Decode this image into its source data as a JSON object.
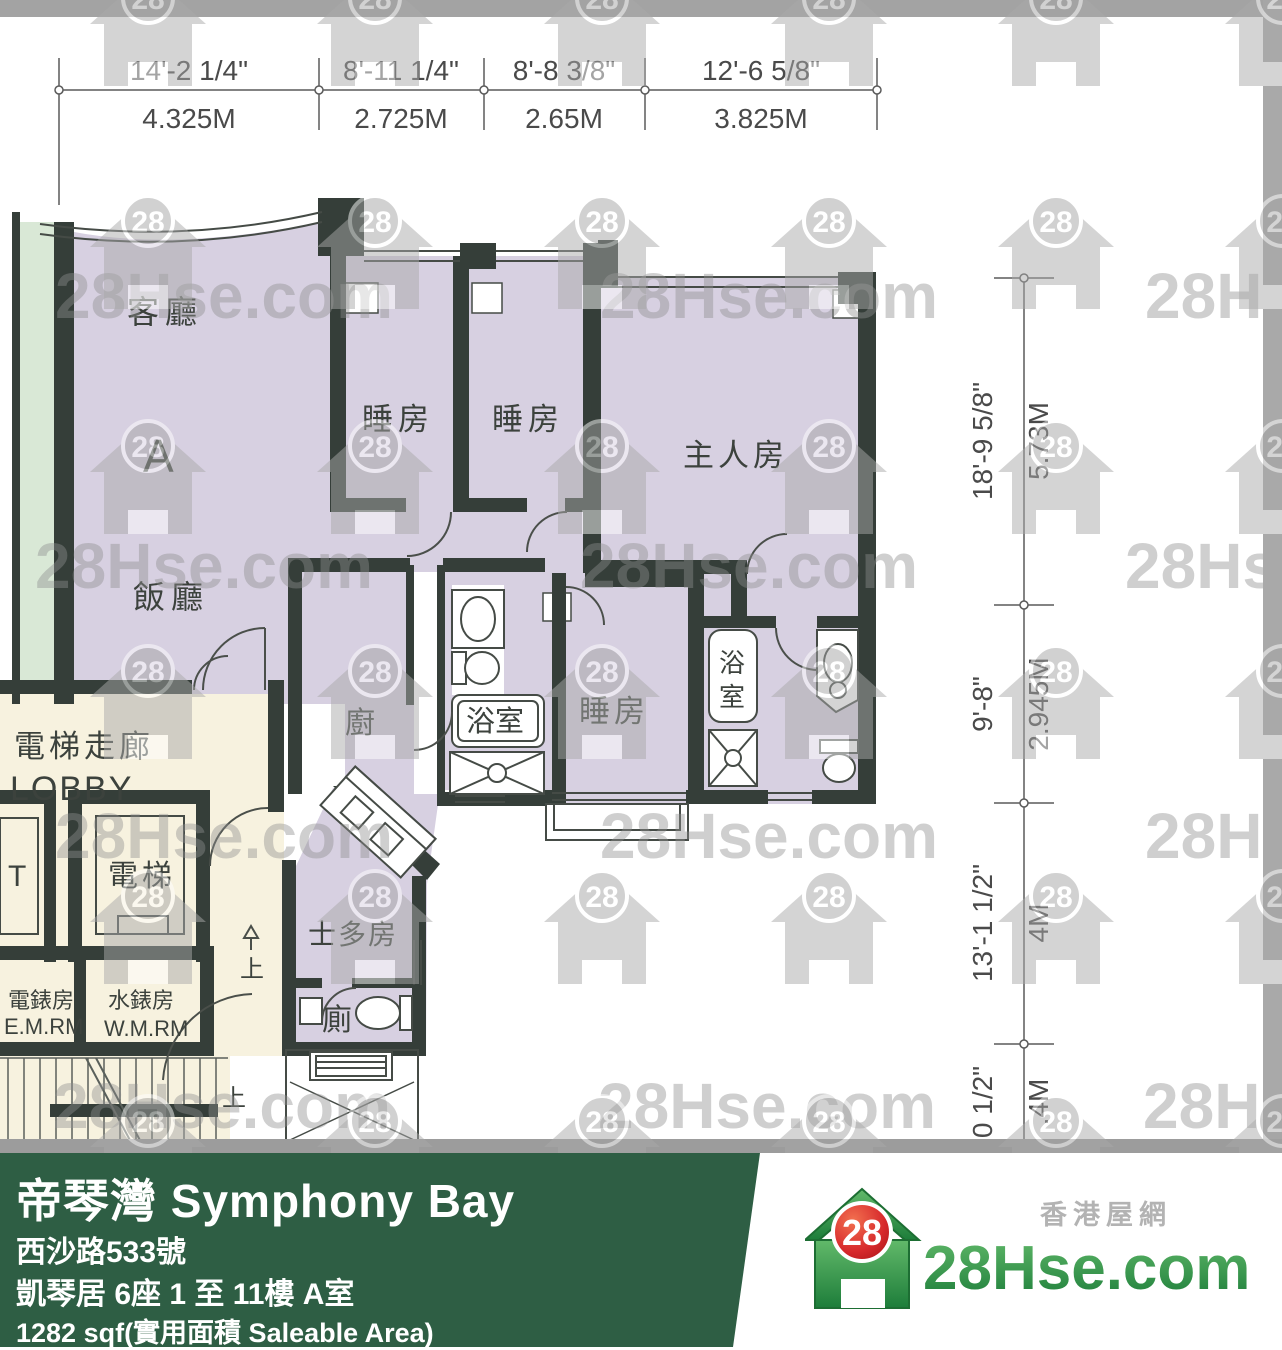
{
  "watermark": {
    "text": "28Hse.com",
    "badge": "28"
  },
  "dims_top": {
    "feet": [
      "14'-2 1/4\"",
      "8'-11 1/4\"",
      "8'-8 3/8\"",
      "12'-6 5/8\""
    ],
    "meters": [
      "4.325M",
      "2.725M",
      "2.65M",
      "3.825M"
    ]
  },
  "dims_right": {
    "feet": [
      "18'-9 5/8\"",
      "9'-8\"",
      "13'-1 1/2\"",
      "0 1/2\""
    ],
    "meters": [
      "5.73M",
      "2.945M",
      "4M",
      ".4M"
    ]
  },
  "rooms": {
    "living": "客廳",
    "flat": "A",
    "dining": "飯廳",
    "bedroom": "睡房",
    "master": "主人房",
    "kitchen": "廚",
    "bath": "浴室",
    "bath_v1": "浴",
    "bath_v2": "室",
    "lobby_cn": "電梯走廊",
    "lobby_en": "LOBBY",
    "lift": "電梯",
    "lift_cut": "T",
    "emr_cn": "電錶房",
    "emr_en": "E.M.RM",
    "wmr_cn": "水錶房",
    "wmr_en": "W.M.RM",
    "store": "士多房",
    "toilet": "廁",
    "up": "上"
  },
  "footer": {
    "title": "帝琴灣 Symphony Bay",
    "address": "西沙路533號",
    "block": "凱琴居 6座 1 至 11樓 A室",
    "area": "1282 sqf(實用面積 Saleable Area)",
    "portal_cn": "香港屋網",
    "logo_text": "28Hse.com",
    "logo_badge": "28"
  },
  "colors": {
    "wall": "#353e39",
    "floor": "#d7d0e1",
    "green_strip": "#d9e8d6",
    "lobby": "#f7f2df",
    "footer_green": "#2e5e44",
    "watermark_gray": "#a9a9a9",
    "logo_red": "#d7292c",
    "logo_green": "#2f9147"
  }
}
